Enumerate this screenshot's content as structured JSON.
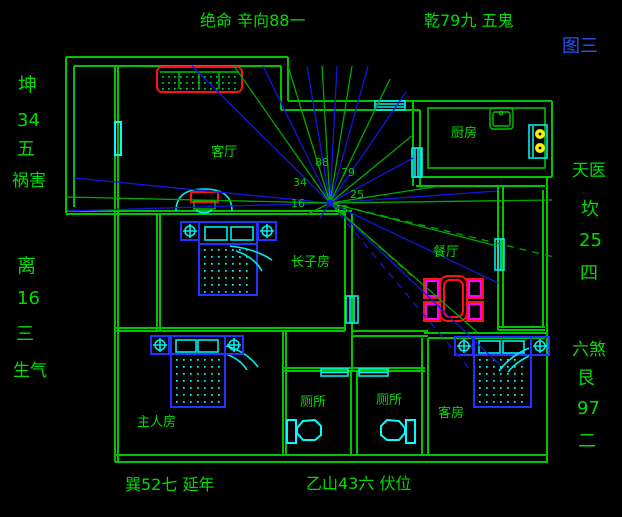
{
  "figure": {
    "label": "图三"
  },
  "compass": {
    "top_left": "绝命 辛向88一",
    "top_right": "乾79九 五鬼",
    "bottom_left": "巽52七 延年",
    "bottom_center": "乙山43六 伏位",
    "left_upper": {
      "trigram": "坤",
      "number": "34",
      "star": "五",
      "name": "祸害"
    },
    "left_lower": {
      "trigram": "离",
      "number": "16",
      "star": "三",
      "name": "生气"
    },
    "right_upper": {
      "name": "天医",
      "trigram": "坎",
      "number": "25",
      "star": "四"
    },
    "right_lower": {
      "name": "六煞",
      "trigram": "艮",
      "number": "97",
      "star": "二"
    }
  },
  "rooms": {
    "living": "客厅",
    "kitchen": "厨房",
    "dining": "餐厅",
    "eldest_son": "长子房",
    "master": "主人房",
    "guest": "客房",
    "toilet_left": "厕所",
    "toilet_right": "厕所"
  },
  "center_numbers": {
    "n88": "88",
    "n79": "79",
    "n34": "34",
    "n25": "25",
    "n16": "16",
    "n43": "43"
  },
  "colors": {
    "background": "#000000",
    "wall_green": "#00c400",
    "text_green": "#00dc00",
    "ray_blue": "#1515dd",
    "ray_green": "#00a800",
    "window_cyan": "#00ffff",
    "furniture_blue": "#2233ff",
    "accent_red": "#ff1111",
    "accent_magenta": "#ff00ff",
    "burner_yellow": "#ffee00",
    "figure_blue": "#2255ff"
  }
}
